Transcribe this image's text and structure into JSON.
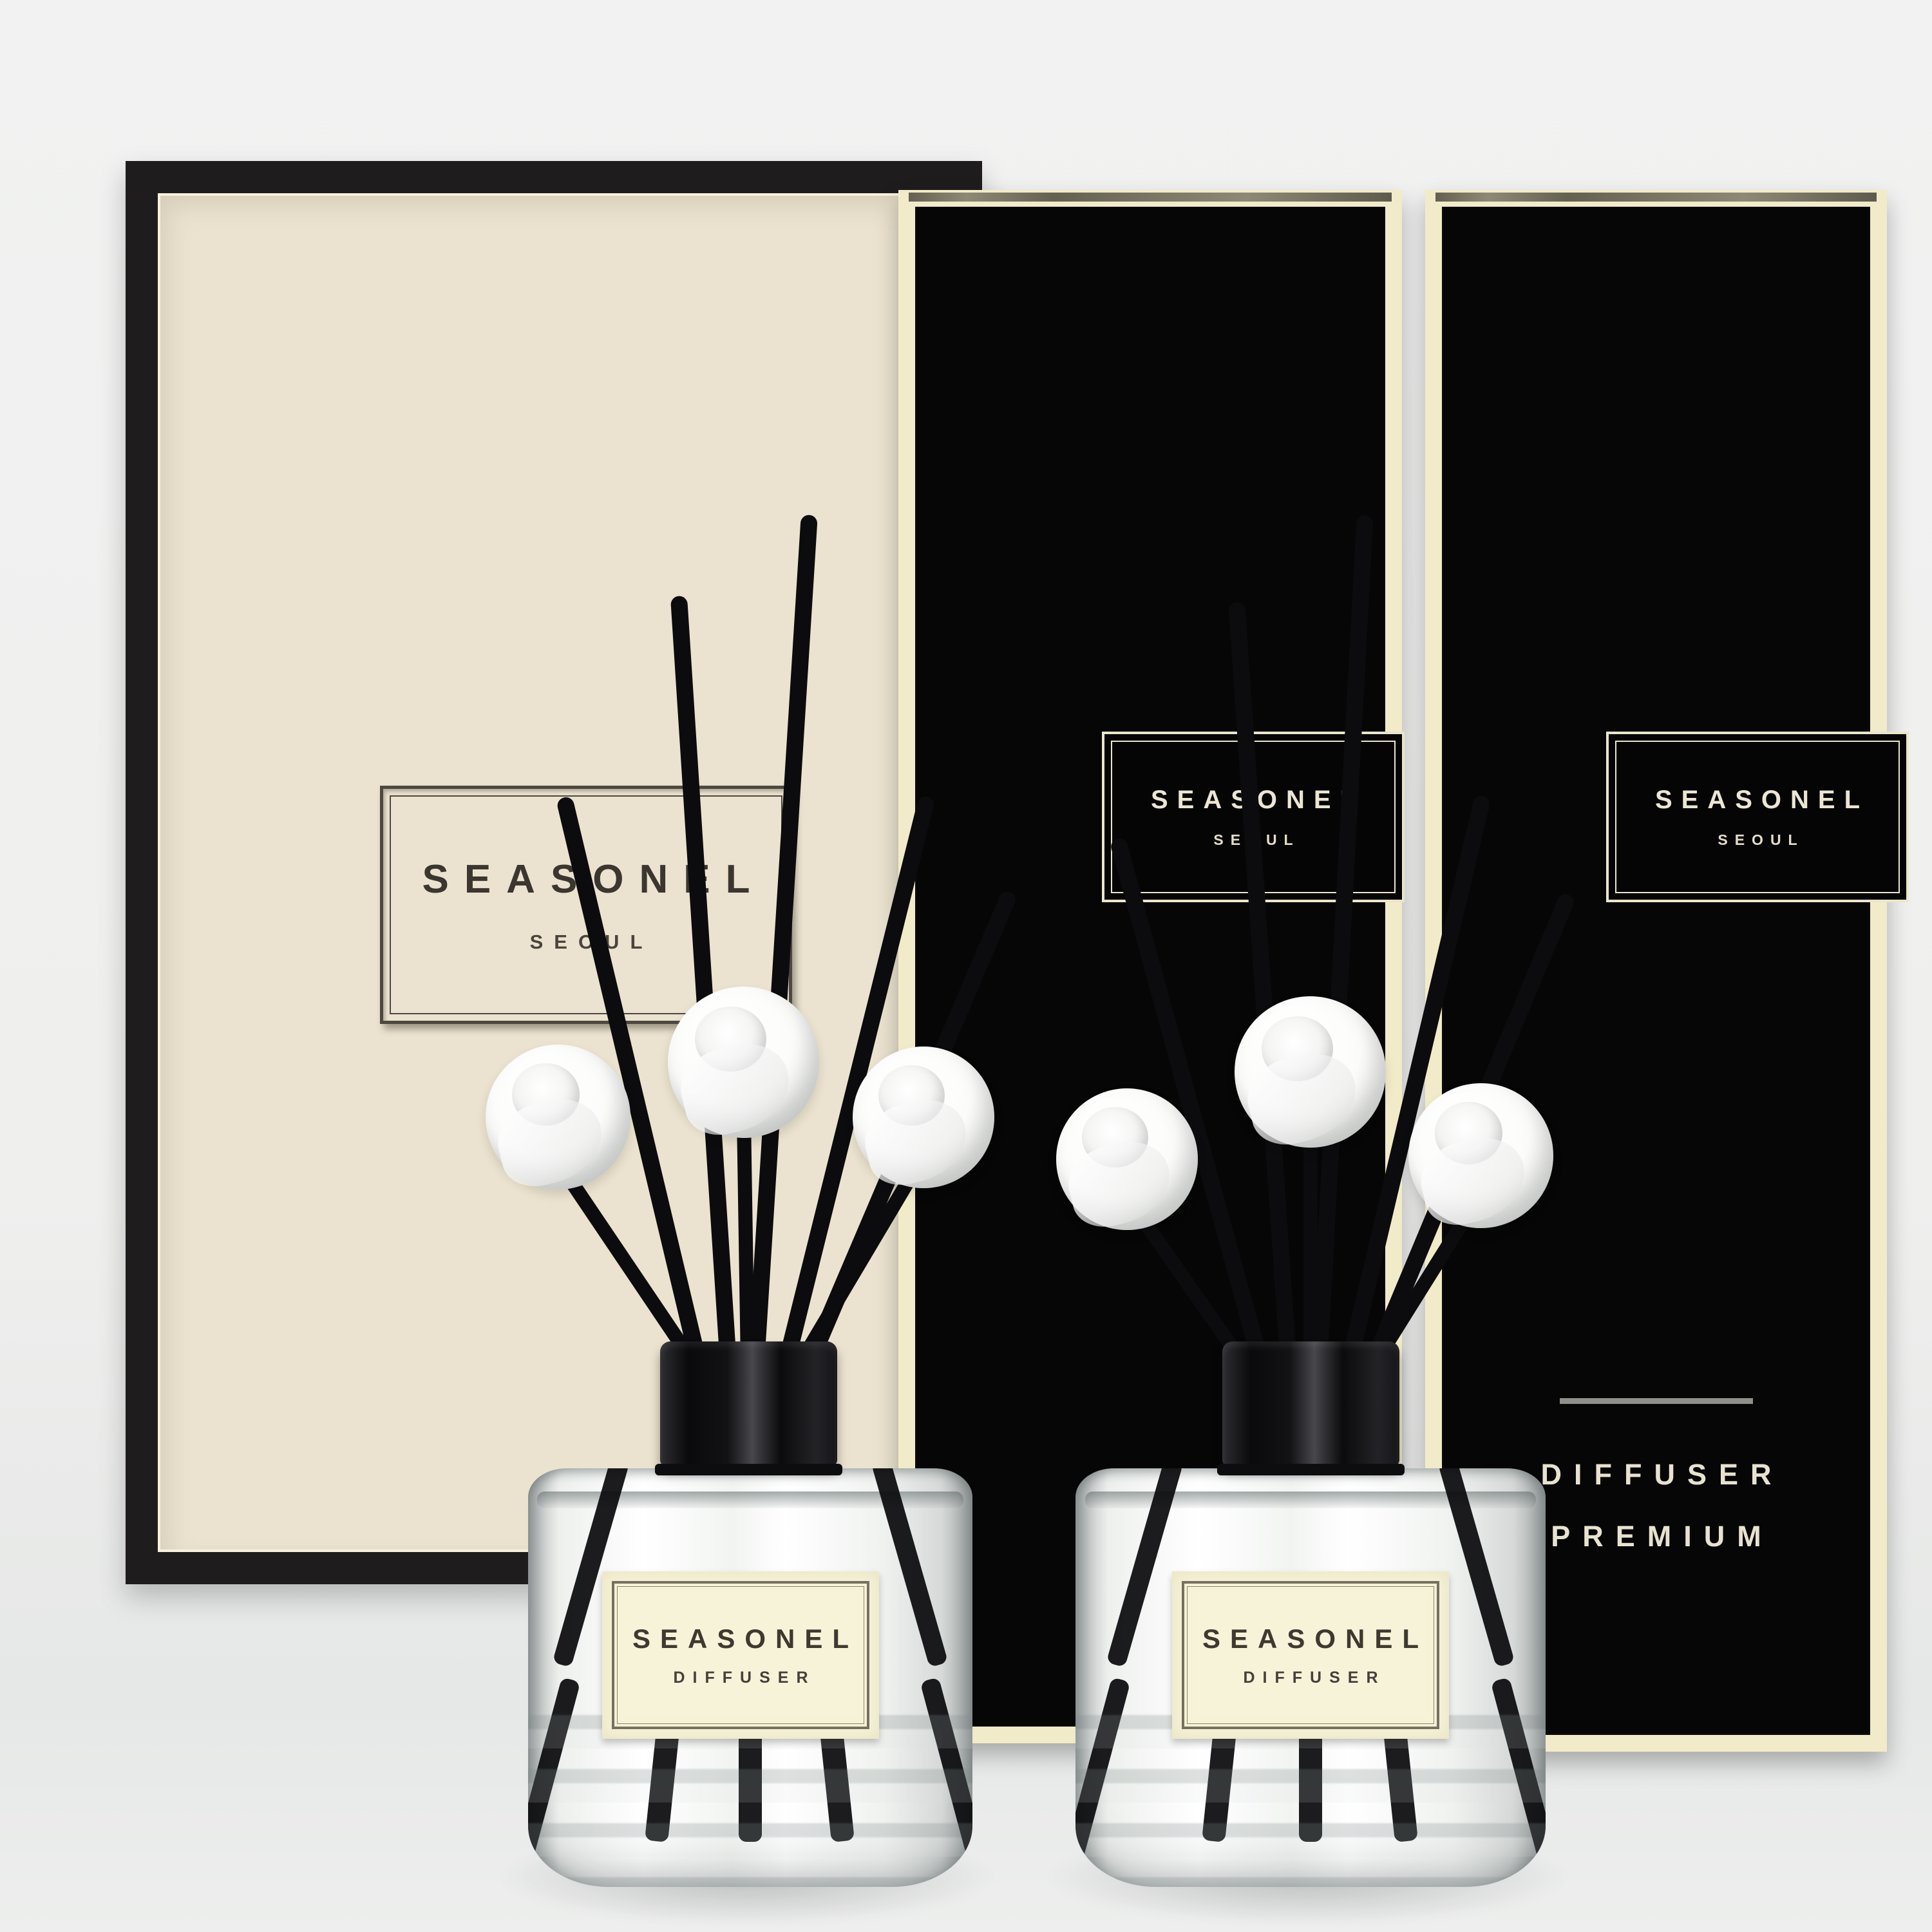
{
  "scene_description": "Two SEASONEL reed diffuser bottles with black reeds and white sola roses in front of one cream gift box and two tall black product boxes",
  "cream_box": {
    "brand": "SEASONEL",
    "city": "SEOUL"
  },
  "black_box_left": {
    "brand": "SEASONEL",
    "city": "SEOUL"
  },
  "black_box_right": {
    "brand": "SEASONEL",
    "city": "SEOUL",
    "footer_line1": "DIFFUSER",
    "footer_line2": "PREMIUM"
  },
  "bottle_left": {
    "label_brand": "SEASONEL",
    "label_product": "DIFFUSER"
  },
  "bottle_right": {
    "label_brand": "SEASONEL",
    "label_product": "DIFFUSER"
  },
  "colors": {
    "background": "#eff0ef",
    "cream_box_face": "#ebe3cf",
    "cream_box_frame": "#1f1c1d",
    "black_box_face": "#060606",
    "black_box_border": "#f2ebc9",
    "logo_text_dark": "#3b362f",
    "logo_text_cream": "#ece6d2",
    "bottle_label_bg": "#f7f3d8",
    "label_text": "#3e3930",
    "reed": "#0c0b0d",
    "rose": "#ffffff",
    "footer_divider": "#8f8f8b"
  }
}
